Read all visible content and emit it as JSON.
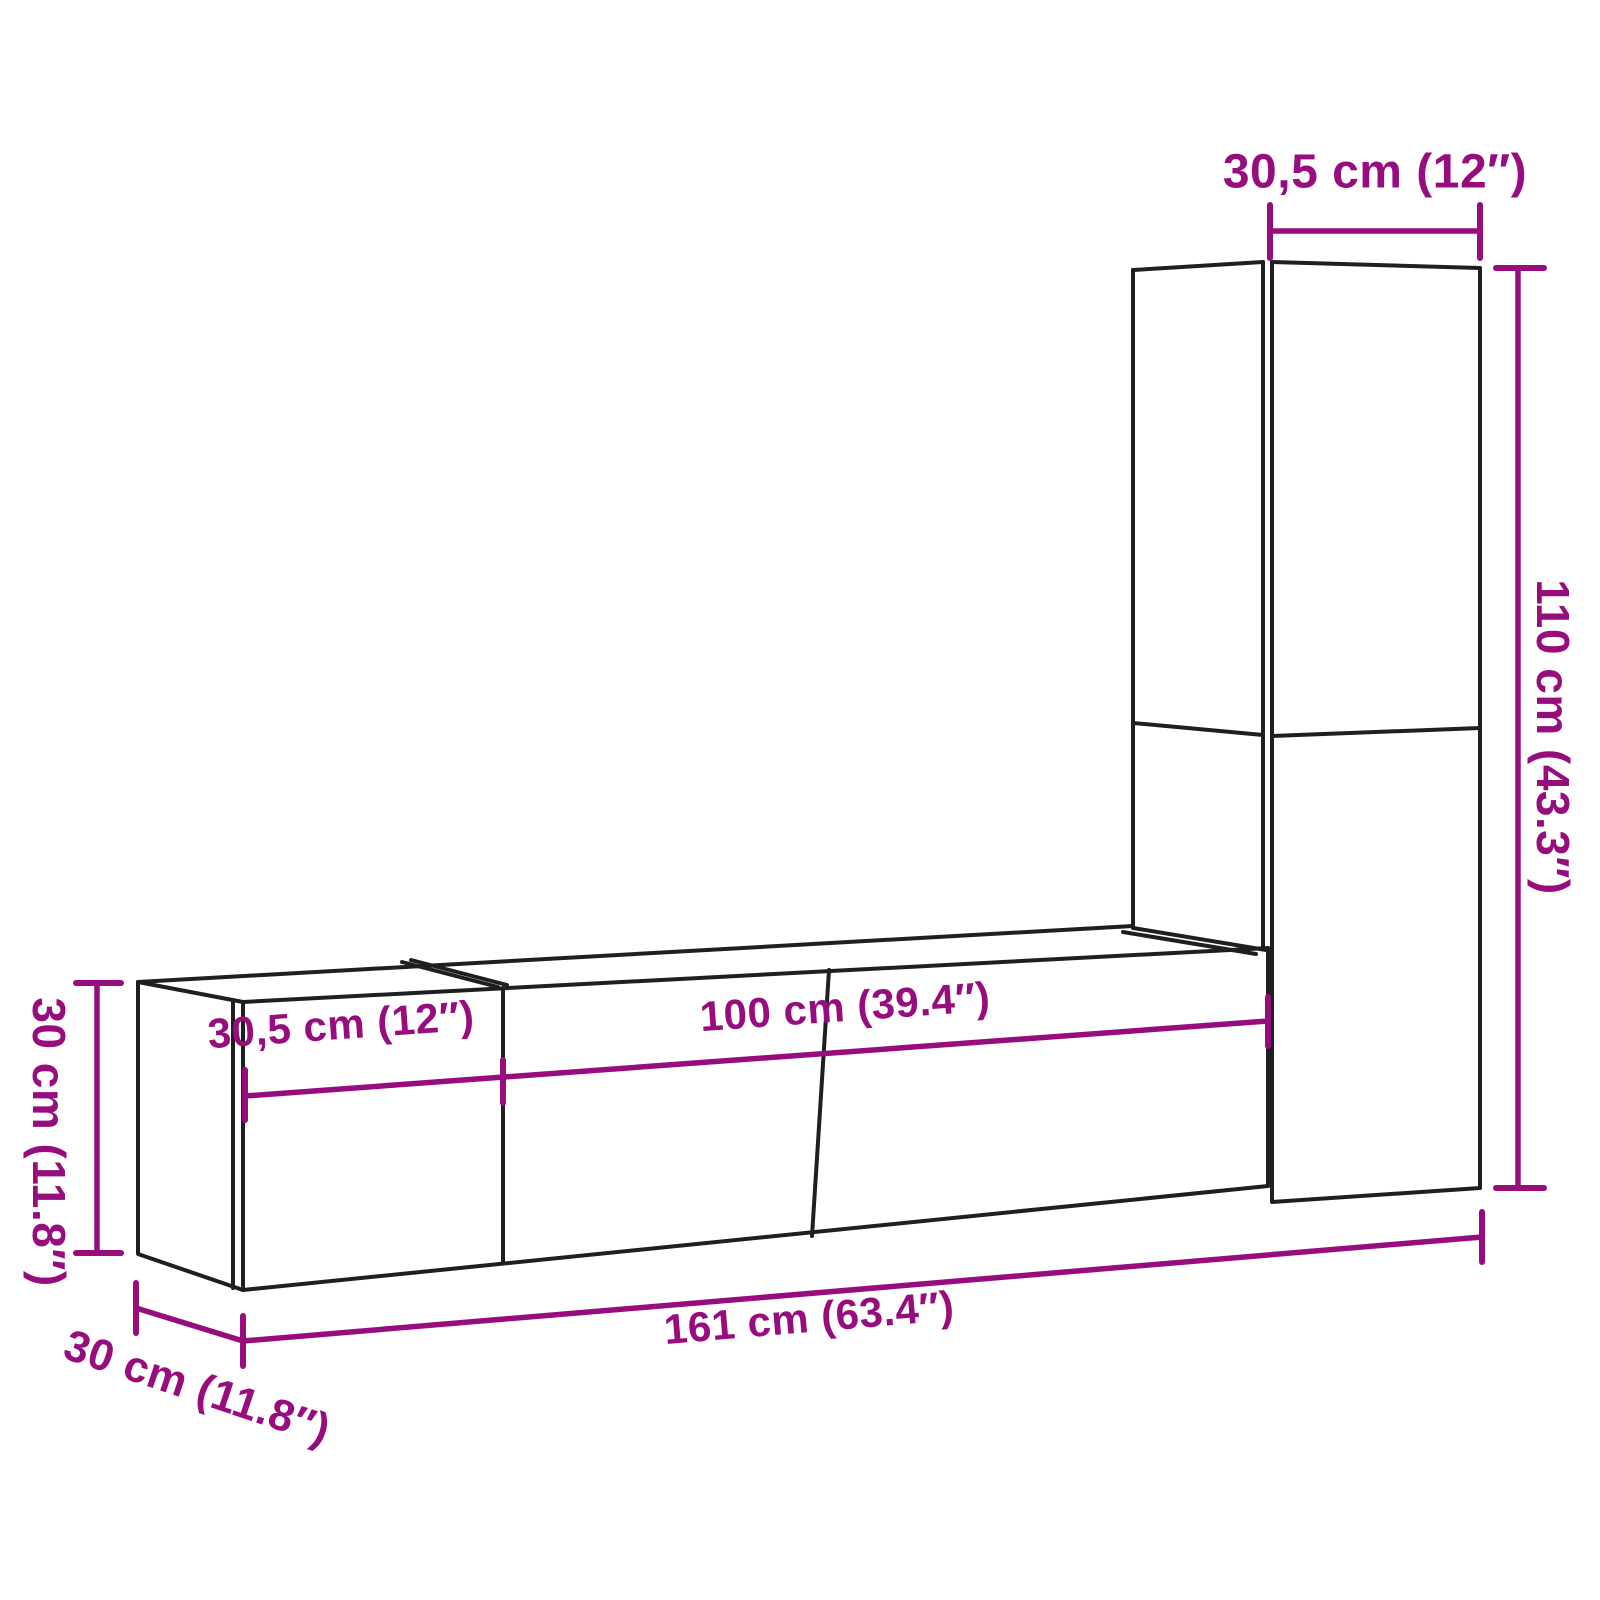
{
  "diagram": {
    "title": "TV wall cabinet set dimension diagram",
    "accent_color": "#970d7e",
    "outline_color": "#1f1f1f",
    "background_color": "#ffffff",
    "labels": {
      "top_width": "30,5 cm (12″)",
      "right_height": "110 cm (43.3″)",
      "left_height": "30 cm (11.8″)",
      "depth": "30 cm (11.8″)",
      "total_width": "161 cm (63.4″)",
      "left_unit_width": "30,5 cm (12″)",
      "center_unit_width": "100 cm (39.4″)"
    }
  }
}
